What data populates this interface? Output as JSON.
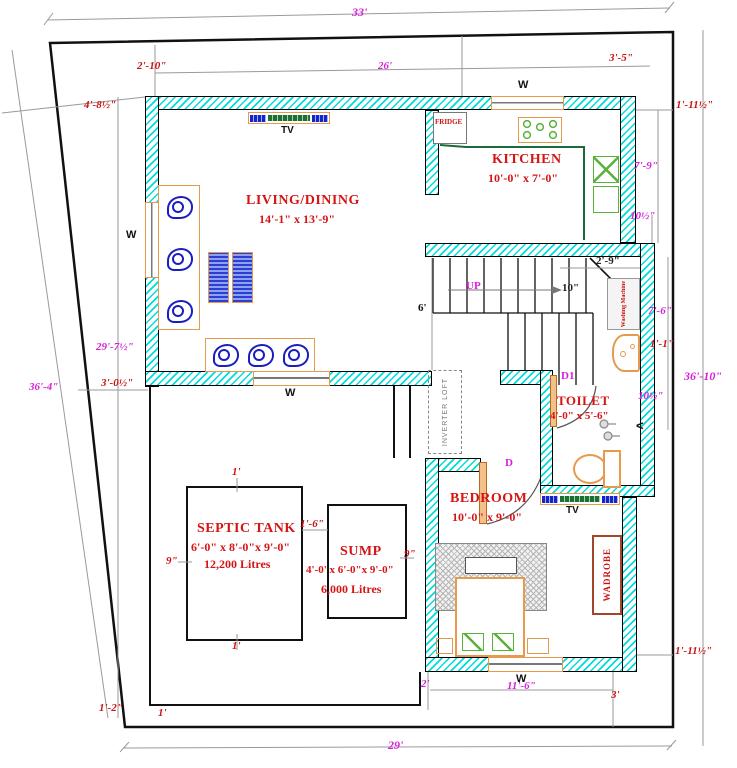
{
  "drawing_type": "house floor plan",
  "rooms": {
    "living": {
      "name": "LIVING/DINING",
      "size": "14'-1\" x 13'-9\""
    },
    "kitchen": {
      "name": "KITCHEN",
      "size": "10'-0\" x 7'-0\""
    },
    "toilet": {
      "name": "TOILET",
      "size": "4'-0\" x 5'-6\""
    },
    "bedroom": {
      "name": "BEDROOM",
      "size": "10'-0\" x 9'-0\""
    },
    "septic_tank": {
      "name": "SEPTIC TANK",
      "size": "6'-0\" x 8'-0\"x 9'-0\"",
      "capacity": "12,200 Litres"
    },
    "sump": {
      "name": "SUMP",
      "size": "4'-0' x 6'-0\"x 9'-0\"",
      "capacity": "6,000 Litres"
    }
  },
  "fixtures": {
    "fridge": "FRIDGE",
    "tv_living": "TV",
    "tv_bedroom": "TV",
    "wardrobe": "WADROBE",
    "washing_machine": "Washing Machine",
    "inverter_loft": "INVERTER LOFT",
    "stairs_up": "UP",
    "door_bedroom": "D",
    "door_toilet": "D1",
    "window_top": "W",
    "window_left": "W",
    "window_living_bottom": "W",
    "window_bedroom": "W",
    "arrow_left": "<"
  },
  "dims": {
    "plot_width_top": "33'",
    "offset_top_left": "2'-10\"",
    "building_width_top": "26'",
    "offset_top_right": "3'-5\"",
    "gap_top_right": "1'-11½\"",
    "kitchen_right_height": "7'-9\"",
    "step_top_right": "10½\"",
    "corner_top_left": "4'-8½\"",
    "building_height_left": "29'-7½\"",
    "gap_left": "3'-0½\"",
    "plot_height_left": "36'-4\"",
    "stair_head": "2'-9\"",
    "stair_tread": "10\"",
    "stair_right_height": "7'-6\"",
    "gap_right_mid": "1'-1\"",
    "plot_height_right": "36'-10\"",
    "step_right_mid": "10½\"",
    "passage_width": "6'",
    "septic_top": "1'",
    "septic_bottom": "1'",
    "septic_left": "9\"",
    "septic_sump_gap": "1'-6\"",
    "sump_right": "9\"",
    "gap_bottom_right": "1'-11½\"",
    "yard_step": "2'",
    "bedroom_width_bottom": "11'-6\"",
    "offset_bottom_right": "3'",
    "corner_bottom_left": "1'-2\"",
    "wall_offset_bottom": "1'",
    "plot_width_bottom": "29'"
  }
}
